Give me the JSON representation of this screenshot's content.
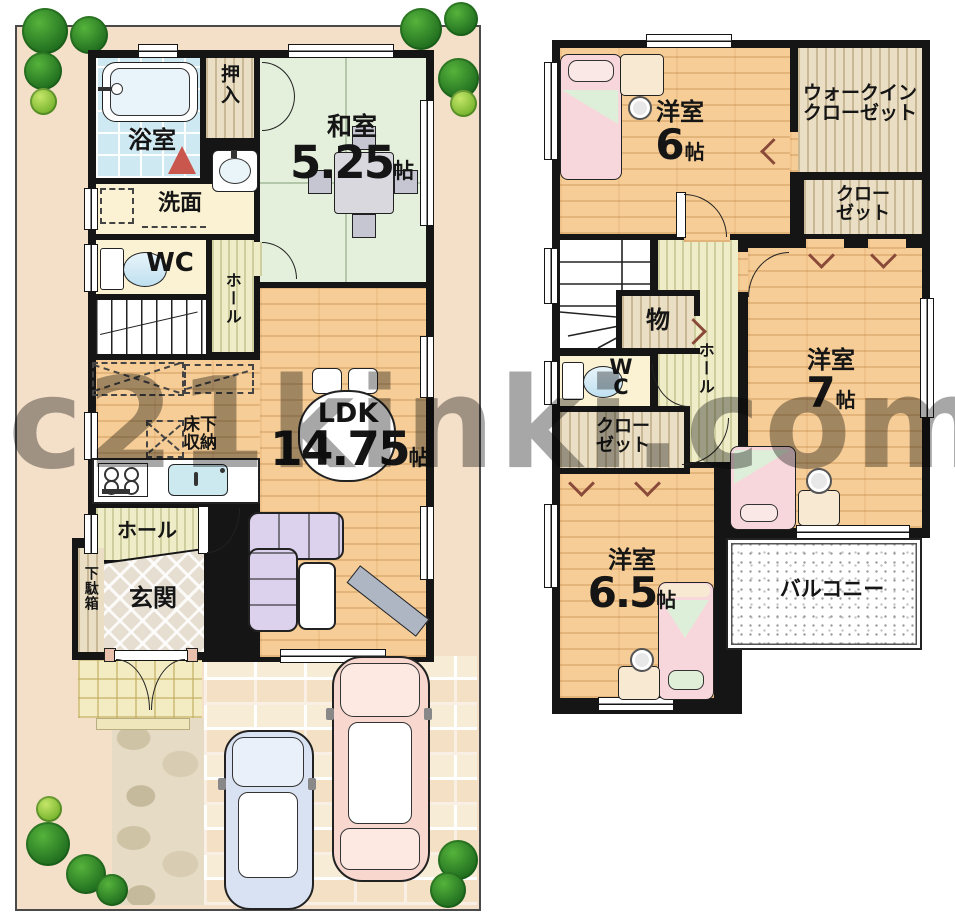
{
  "watermark": "c21kinki.com",
  "floor1": {
    "bath_label": "浴室",
    "oshiire_label": "押入",
    "washitsu_label": "和室",
    "washitsu_size": "5.25",
    "washitsu_unit": "帖",
    "senmen_label": "洗面",
    "wc_label": "WC",
    "hall_upper_label": "ホール",
    "yukashita_label": "床下\n収納",
    "ldk_label": "LDK",
    "ldk_size": "14.75",
    "ldk_unit": "帖",
    "hall_lower_label": "ホール",
    "getabako_label": "下駄箱",
    "genkan_label": "玄関"
  },
  "floor2": {
    "bedroom6_label": "洋室",
    "bedroom6_size": "6",
    "bedroom6_unit": "帖",
    "wic_label": "ウォークイン\nクローゼット",
    "closet_top_label": "クロー\nゼット",
    "storage_label": "物",
    "wc_label": "WC",
    "hall_label": "ホール",
    "bedroom7_label": "洋室",
    "bedroom7_size": "7",
    "bedroom7_unit": "帖",
    "closet_mid_label": "クロー\nゼット",
    "bedroom65_label": "洋室",
    "bedroom65_size": "6.5",
    "bedroom65_unit": "帖",
    "balcony_label": "バルコニー"
  },
  "colors": {
    "lot_peach": "#F4DFC8",
    "wood_floor": "#F6CD96",
    "tatami_green": "#E4F0DC",
    "bath_blue": "#CFE9F2",
    "cream_room": "#FAF2D2",
    "closet_wood": "#EADFC4",
    "hall_stripe": "#EFEDC8",
    "sofa_lavender": "#DCD2EE",
    "bed_pink": "#F8D7DC",
    "car_blue": "#D9E2F2",
    "car_pink": "#F8D8CE",
    "tree_green": "#2E8B2E",
    "wall_black": "#151515",
    "watermark_gray": "#5F5F5F"
  }
}
